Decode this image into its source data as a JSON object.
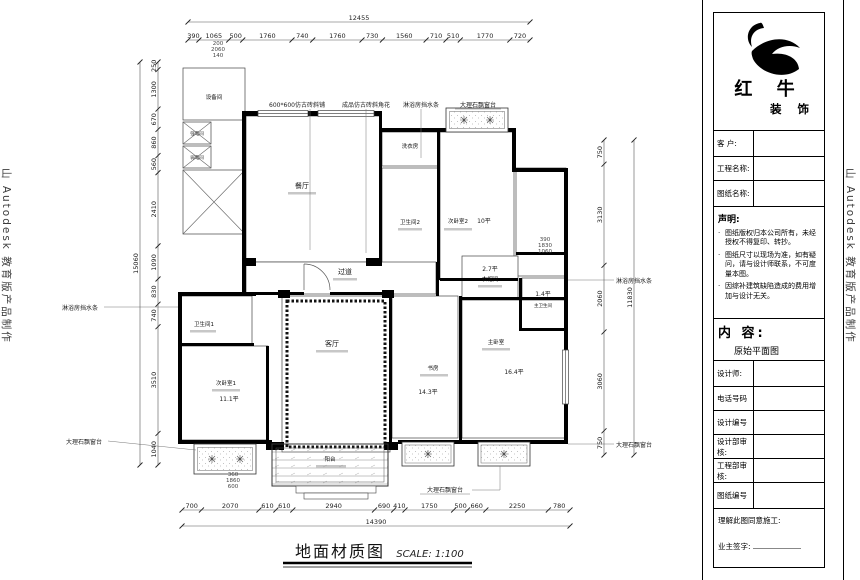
{
  "watermarks": {
    "left": "山 Autodesk 教育版产品制作",
    "right": "山 Autodesk 教育版产品制作"
  },
  "title_block": {
    "brand_line1": "红 牛",
    "brand_line2": "装 饰",
    "customer_label": "客  户:",
    "project_name_label": "工程名称:",
    "drawing_name_label": "图纸名称:",
    "statement_title": "声明:",
    "statement_items": [
      "图纸版权归本公司所有，未经授权不得复印、转抄。",
      "图纸尺寸以现场为准，如有疑问，请与设计师联系，不可度量本图。",
      "因综补建筑缺陷造成的费用增加与设计无关。"
    ],
    "content_label": "内 容:",
    "content_value": "原始平面图",
    "designer_label": "设计师:",
    "phone_label": "电话号码",
    "design_no_label": "设计编号",
    "design_dept_label": "设计部审核:",
    "engineering_dept_label": "工程部审核:",
    "drawing_no_label": "图纸编号",
    "agree_label": "理解此图同意施工:",
    "owner_sign_label": "业主签字:"
  },
  "drawing_title": {
    "name": "地面材质图",
    "scale": "SCALE: 1:100"
  },
  "rooms": {
    "equipment": "设备间",
    "strong_elec": "强电间",
    "weak_elec": "弱电间",
    "dining": "餐厅",
    "laundry": "洗衣房",
    "bath2": "卫生间2",
    "bed2": "次卧室2",
    "bed2_area": "10平",
    "hallway": "过道",
    "cloakroom": "衣帽间",
    "cloakroom_area": "2.7平",
    "master_bath": "主卫生间",
    "master_bath_area": "1.4平",
    "living": "客厅",
    "master": "主卧室",
    "master_area": "16.4平",
    "study": "书房",
    "study_area": "14.3平",
    "bath1": "卫生间1",
    "bed1": "次卧室1",
    "bed1_area": "11.1平",
    "balcony": "阳台"
  },
  "annotations": {
    "tile": "600*600仿古砖斜铺",
    "corner_flower": "成品仿古砖斜角花",
    "shower_strip": "淋浴房挡水条",
    "marble_sill": "大理石飘窗台"
  },
  "small_dims": {
    "top": [
      "200",
      "2060",
      "140"
    ],
    "right_mid": [
      "390",
      "1830",
      "1060"
    ],
    "bottom_left": [
      "360",
      "1860",
      "600"
    ]
  },
  "dimensions": {
    "top": {
      "total": "12455",
      "segments": [
        "390",
        "1065",
        "500",
        "1760",
        "740",
        "1760",
        "730",
        "1560",
        "710",
        "510",
        "1770",
        "720"
      ]
    },
    "bottom": {
      "total": "14390",
      "segments": [
        "700",
        "2070",
        "610",
        "610",
        "2940",
        "690",
        "410",
        "1750",
        "500",
        "660",
        "2250",
        "780"
      ]
    },
    "left": {
      "total": "15060",
      "segments": [
        "250",
        "1300",
        "670",
        "860",
        "560",
        "2410",
        "1090",
        "830",
        "740",
        "3510",
        "1040"
      ]
    },
    "right": {
      "total": "11830",
      "segments": [
        "750",
        "3130",
        "2060",
        "3060",
        "750"
      ]
    }
  }
}
